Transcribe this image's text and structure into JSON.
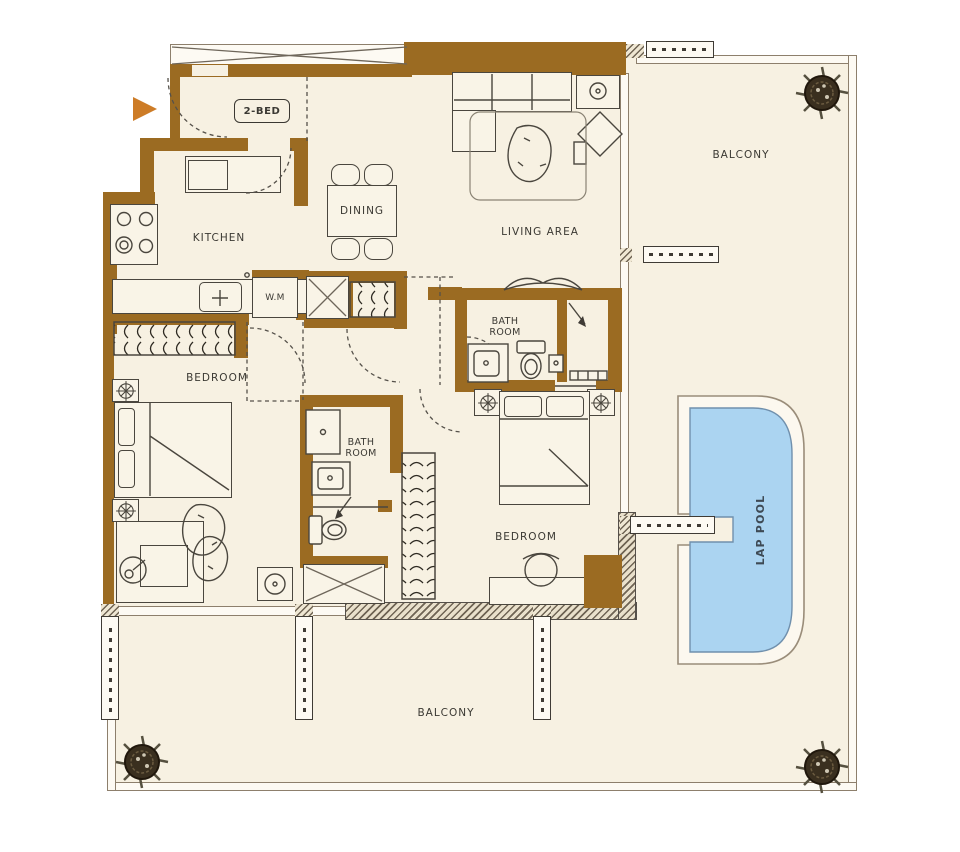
{
  "plan": {
    "labels": {
      "unit": "2-BED",
      "kitchen": "KITCHEN",
      "dining": "DINING",
      "living_area": "LIVING AREA",
      "balcony_right": "BALCONY",
      "balcony_bottom": "BALCONY",
      "bedroom_left": "BEDROOM",
      "bedroom_right": "BEDROOM",
      "bathroom_top": "BATH ROOM",
      "bathroom_mid": "BATH ROOM",
      "washing_machine": "W.M",
      "lap_pool": "LAP POOL"
    },
    "colors": {
      "wall": "#9b6b22",
      "floor": "#f7f1e2",
      "outline": "#4a463e",
      "thinwall": "#8d7f6c",
      "hatch": "#6f6454",
      "pool": "#abd4f1",
      "poolstroke": "#7090ad",
      "pooldeck": "#fcf8ef",
      "arrow": "#cd7c27",
      "text": "#3b3933",
      "pooltext": "#3e4a55",
      "plant": "#3a2f1f"
    }
  }
}
